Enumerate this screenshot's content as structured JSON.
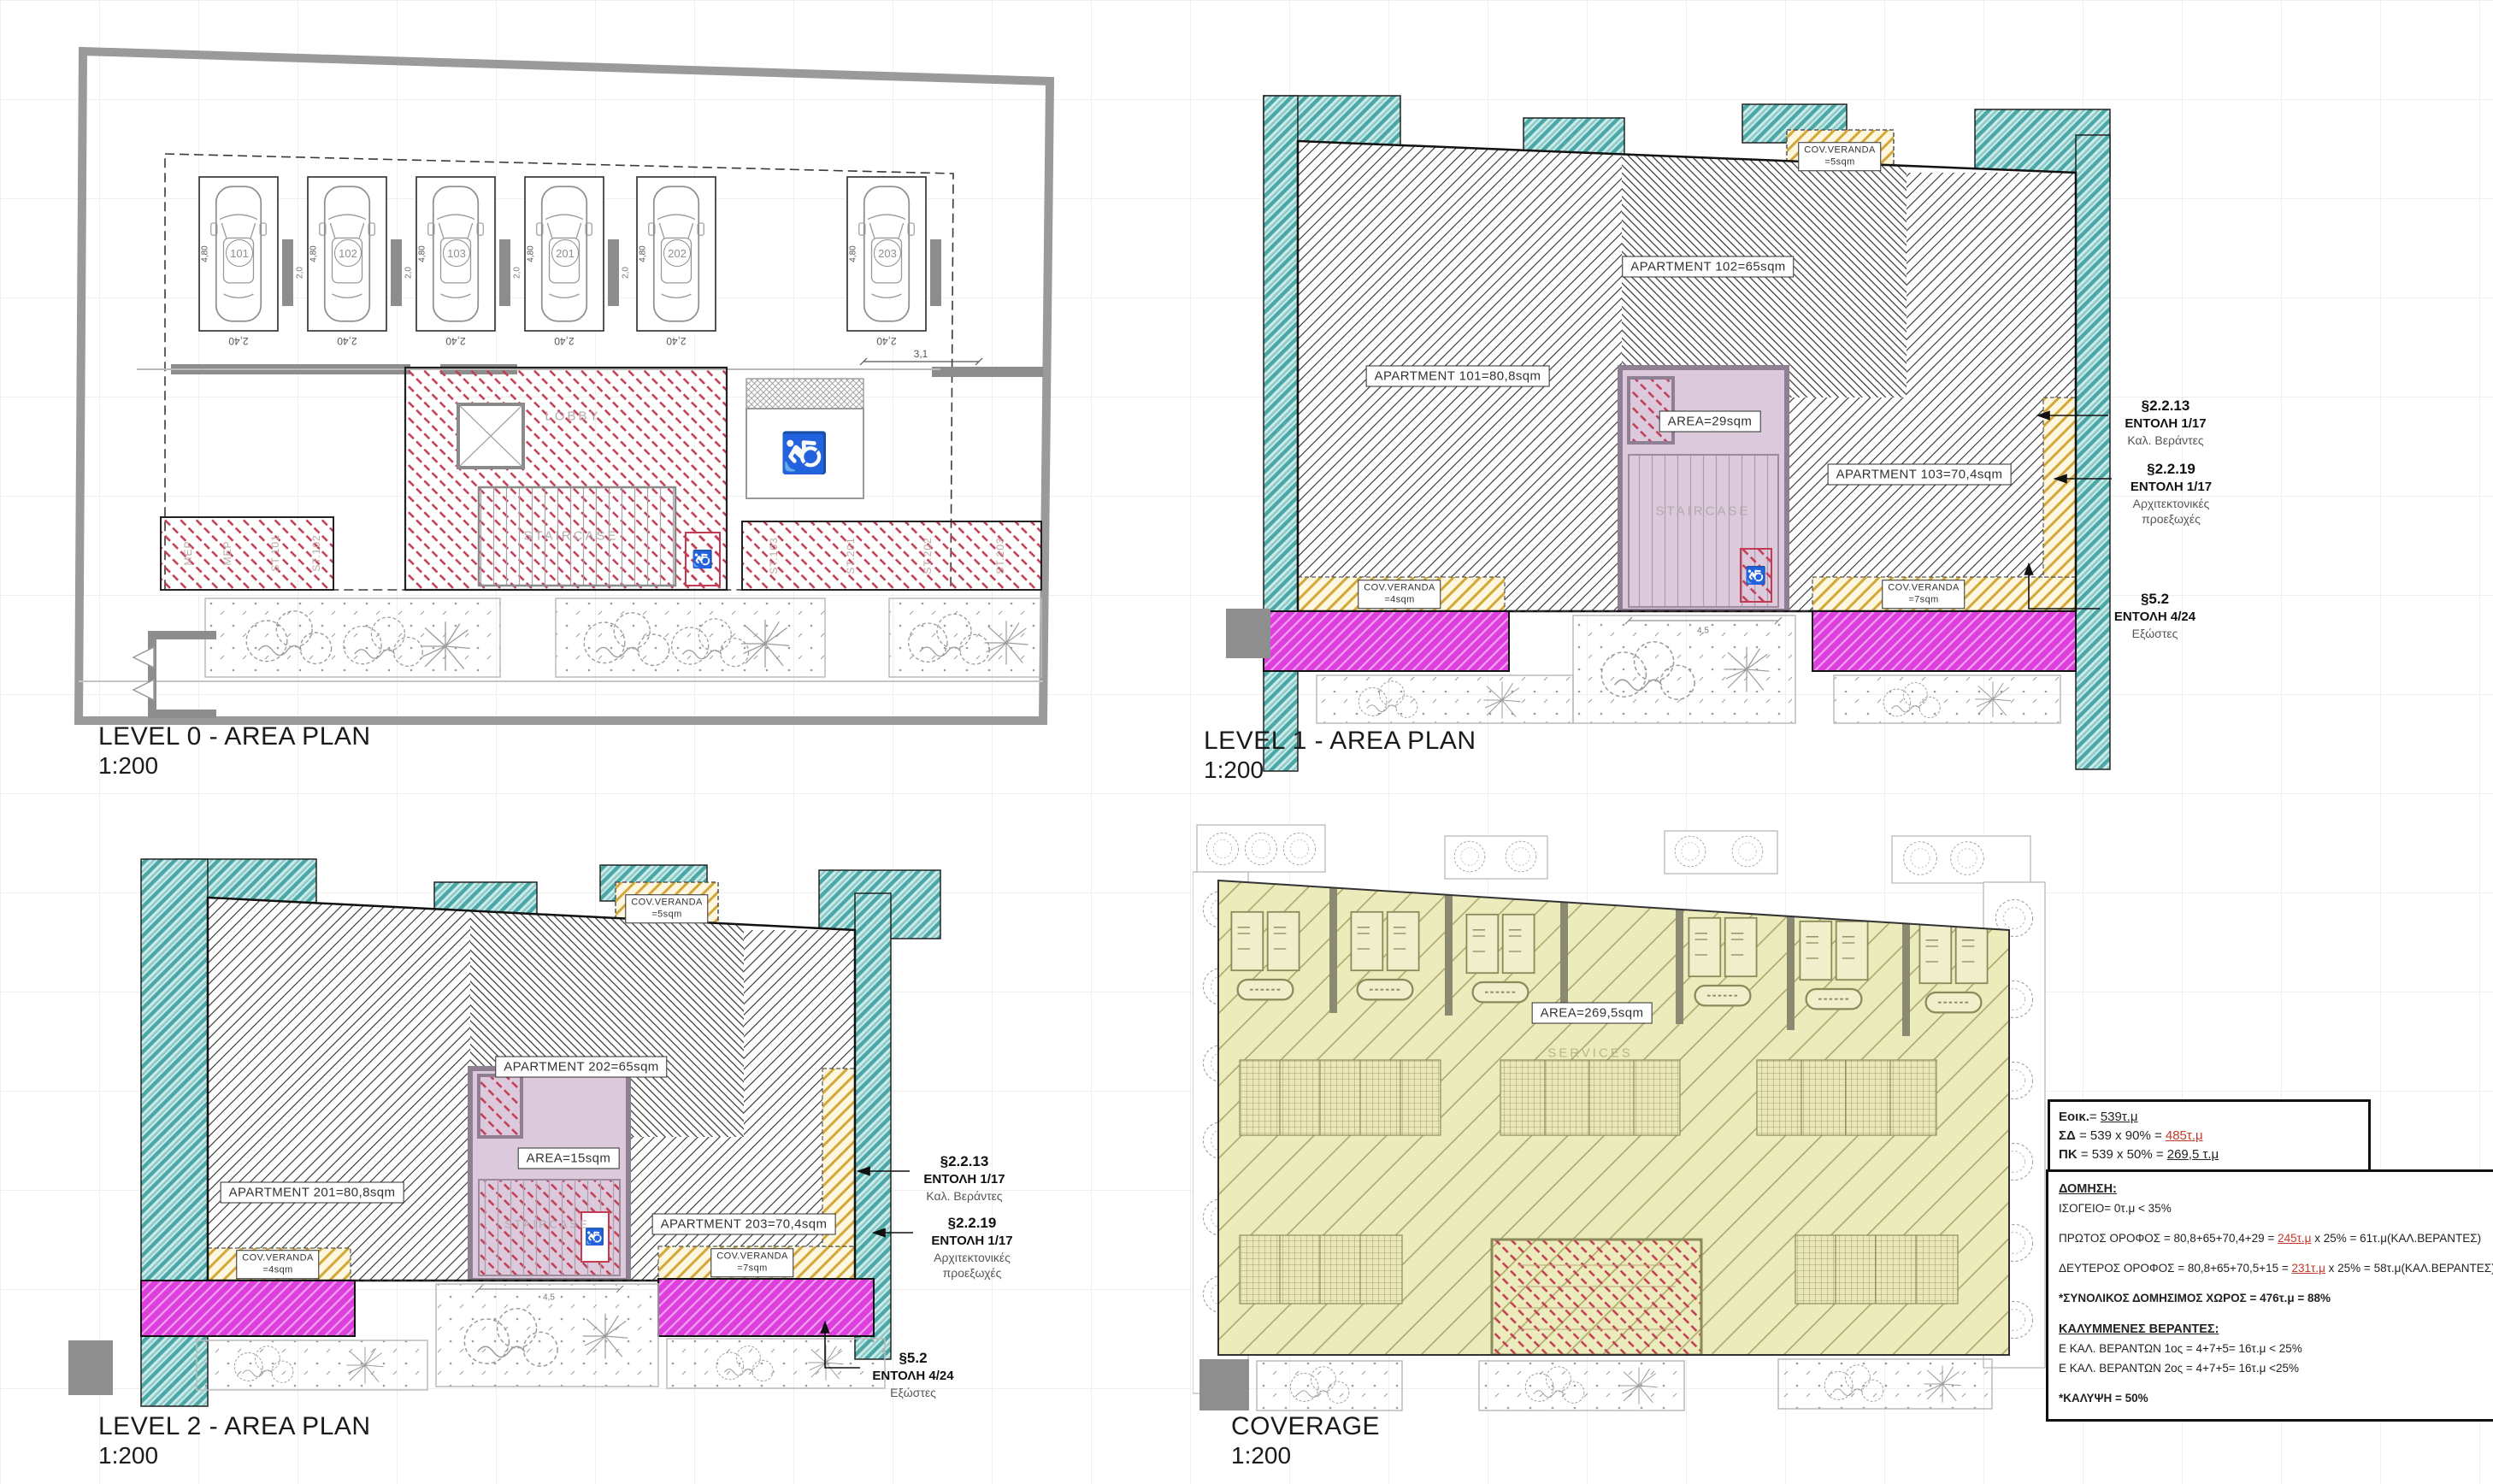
{
  "colors": {
    "red_hatch": "#c23b52",
    "teal": "#49a7a5",
    "yellow": "#d3a738",
    "magenta": "#dd3fdd",
    "khaki": "#ecebbb",
    "lilac": "#dcc9dc",
    "wall_gray": "#8d8d8d",
    "boundary_gray": "#9a9a9a",
    "accent_red": "#c0392b"
  },
  "plans": {
    "level0": {
      "title": "LEVEL 0 - AREA PLAN",
      "scale": "1:200",
      "parking_numbers": [
        "101",
        "102",
        "103",
        "201",
        "202",
        "203"
      ],
      "dims": {
        "stall_width": "2,40",
        "stall_length": "4,80",
        "gap": "2,0",
        "aisle": "3,1"
      },
      "labels": {
        "lobby": "LOBBY",
        "staircase": "STAIRCASE"
      },
      "storage_left": [
        "MEP",
        "MEP",
        "ST.101",
        "ST.102"
      ],
      "storage_right": [
        "ST.103",
        "ST.201",
        "ST.202",
        "ST.203"
      ]
    },
    "level1": {
      "title": "LEVEL 1 - AREA PLAN",
      "scale": "1:200",
      "apartments": [
        "APARTMENT 101=80,8sqm",
        "APARTMENT 102=65sqm",
        "APARTMENT 103=70,4sqm"
      ],
      "core_area": "AREA=29sqm",
      "staircase": "STAIRCASE",
      "dim": "4,5",
      "verandas": [
        {
          "t": "COV.VERANDA",
          "v": "=5sqm"
        },
        {
          "t": "COV.VERANDA",
          "v": "=4sqm"
        },
        {
          "t": "COV.VERANDA",
          "v": "=7sqm"
        }
      ]
    },
    "level2": {
      "title": "LEVEL 2 - AREA PLAN",
      "scale": "1:200",
      "apartments": [
        "APARTMENT 201=80,8sqm",
        "APARTMENT 202=65sqm",
        "APARTMENT 203=70,4sqm"
      ],
      "core_area": "AREA=15sqm",
      "staircase": "STAIRCASE",
      "dim": "4,5",
      "verandas": [
        {
          "t": "COV.VERANDA",
          "v": "=5sqm"
        },
        {
          "t": "COV.VERANDA",
          "v": "=4sqm"
        },
        {
          "t": "COV.VERANDA",
          "v": "=7sqm"
        }
      ]
    },
    "coverage": {
      "title": "COVERAGE",
      "scale": "1:200",
      "area": "AREA=269,5sqm",
      "services": "SERVICES"
    }
  },
  "annotations": {
    "a1": {
      "ref": "§2.2.13",
      "order": "ΕΝΤΟΛΗ 1/17",
      "desc1": "Καλ. Βεράντες"
    },
    "a2": {
      "ref": "§2.2.19",
      "order": "ΕΝΤΟΛΗ 1/17",
      "desc1": "Αρχιτεκτονικές",
      "desc2": "προεξωχές"
    },
    "a3": {
      "ref": "§5.2",
      "order": "ΕΝΤΟΛΗ 4/24",
      "desc1": "Εξώστες"
    }
  },
  "site_box": {
    "l1_label": "Εοικ.",
    "l1_mid": "= ",
    "l1_value": "539τ.μ",
    "l2_label": "ΣΔ",
    "l2_mid": " = 539 x 90% = ",
    "l2_value": "485τ.μ",
    "l3_label": "ΠΚ",
    "l3_mid": " = 539 x 50% = ",
    "l3_value": "269,5 τ.μ"
  },
  "calc_box": {
    "heading": "ΔΟΜΗΣΗ:",
    "ground": "ΙΣΟΓΕΙΟ= 0τ.μ < 35%",
    "first_pre": "ΠΡΩΤΟΣ ΟΡΟΦΟΣ = 80,8+65+70,4+29 =  ",
    "first_red": "245τ.μ",
    "first_post": " x 25% = 61τ.μ(ΚΑΛ.ΒΕΡΑΝΤΕΣ)",
    "second_pre": "ΔΕΥΤΕΡΟΣ ΟΡΟΦΟΣ = 80,8+65+70,5+15 = ",
    "second_red": "231τ.μ",
    "second_post": " x 25% = 58τ.μ(ΚΑΛ.ΒΕΡΑΝΤΕΣ)",
    "total": "*ΣΥΝΟΛΙΚΟΣ ΔΟΜΗΣΙΜΟΣ ΧΩΡΟΣ = 476τ.μ = 88%",
    "verandas_heading": "ΚΑΛΥΜΜΕΝΕΣ ΒΕΡΑΝΤΕΣ:",
    "verandas_l1": "Ε ΚΑΛ. ΒΕΡΑΝΤΩΝ 1ος = 4+7+5= 16τ.μ < 25%",
    "verandas_l2": "Ε ΚΑΛ. ΒΕΡΑΝΤΩΝ 2ος = 4+7+5= 16τ.μ <25%",
    "coverage": "*ΚΑΛΥΨΗ = 50%"
  }
}
